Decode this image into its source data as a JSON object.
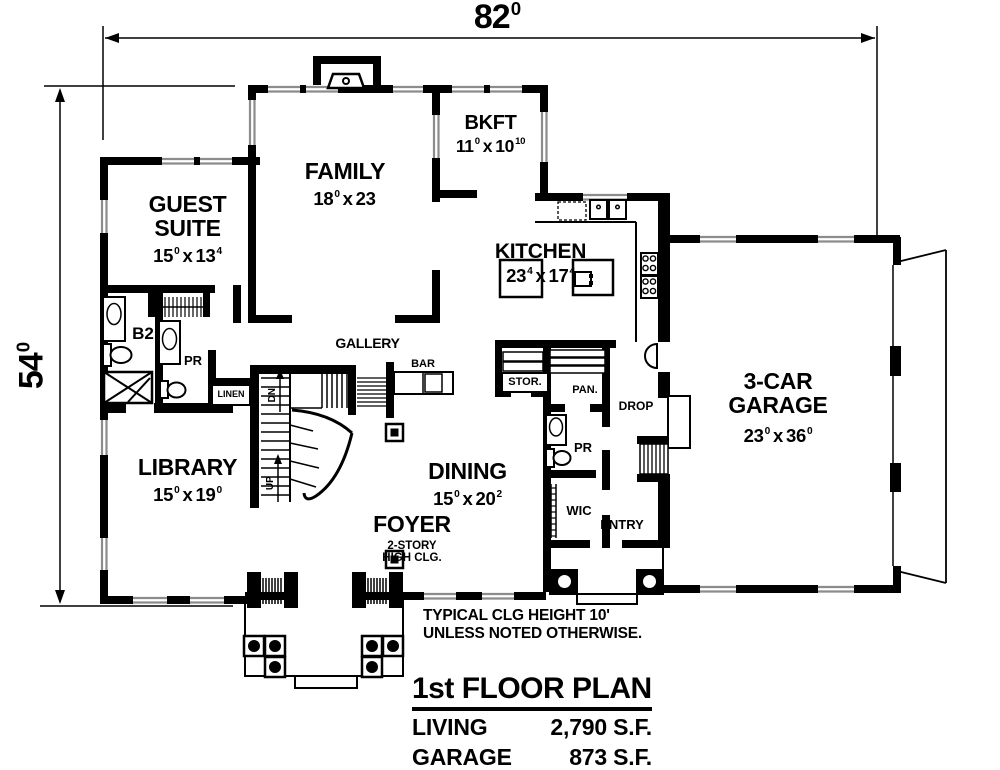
{
  "dimensions": {
    "width": {
      "val": "82",
      "sup": "0"
    },
    "height": {
      "val": "54",
      "sup": "0"
    }
  },
  "rooms": {
    "guest_suite": {
      "name": "GUEST SUITE",
      "w": "15",
      "wsup": "0",
      "sep": "x",
      "l": "13",
      "lsup": "4"
    },
    "family": {
      "name": "FAMILY",
      "w": "18",
      "wsup": "0",
      "sep": "x",
      "l": "23",
      "lsup": ""
    },
    "bkft": {
      "name": "BKFT",
      "w": "11",
      "wsup": "0",
      "sep": "x",
      "l": "10",
      "lsup": "10"
    },
    "kitchen": {
      "name": "KITCHEN",
      "w": "23",
      "wsup": "4",
      "sep": "x",
      "l": "17",
      "lsup": "4"
    },
    "garage": {
      "name": "3-CAR GARAGE",
      "w": "23",
      "wsup": "0",
      "sep": "x",
      "l": "36",
      "lsup": "0"
    },
    "library": {
      "name": "LIBRARY",
      "w": "15",
      "wsup": "0",
      "sep": "x",
      "l": "19",
      "lsup": "0"
    },
    "dining": {
      "name": "DINING",
      "w": "15",
      "wsup": "0",
      "sep": "x",
      "l": "20",
      "lsup": "2"
    },
    "foyer": {
      "name": "FOYER",
      "note": "2-STORY HIGH CLG."
    }
  },
  "labels": {
    "gallery": "GALLERY",
    "bar": "BAR",
    "stor": "STOR.",
    "pan": "PAN.",
    "drop": "DROP",
    "pr_guest": "PR",
    "pr_hall": "PR",
    "b2": "B2",
    "linen": "LINEN",
    "wic": "WIC",
    "entry": "ENTRY",
    "up": "UP",
    "dn": "DN"
  },
  "notes": {
    "line1": "TYPICAL CLG HEIGHT 10'",
    "line2": "UNLESS NOTED OTHERWISE."
  },
  "title_block": {
    "title": "1st FLOOR PLAN",
    "rows": [
      {
        "label": "LIVING",
        "value": "2,790 S.F."
      },
      {
        "label": "GARAGE",
        "value": "873 S.F."
      }
    ]
  }
}
